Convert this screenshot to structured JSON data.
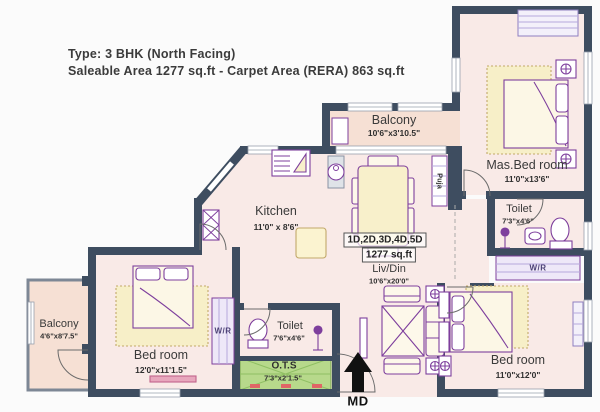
{
  "title": {
    "line1": "Type: 3 BHK (North Facing)",
    "line2": "Saleable Area 1277 sq.ft - Carpet Area (RERA) 863 sq.ft"
  },
  "unit": {
    "variants": "1D,2D,3D,4D,5D",
    "area": "1277 sq.ft"
  },
  "rooms": {
    "balcony_top": {
      "name": "Balcony",
      "dim": "10'6\"x3'10.5\""
    },
    "master_bedroom": {
      "name": "Mas.Bed room",
      "dim": "11'0\"x13'6\""
    },
    "master_toilet": {
      "name": "Toilet",
      "dim": "7'3\"x4'6\""
    },
    "kitchen": {
      "name": "Kitchen",
      "dim": "11'0\" x 8'6\""
    },
    "living_dining": {
      "name": "Liv/Din",
      "dim": "10'6\"x20'0\""
    },
    "left_balcony": {
      "name": "Balcony",
      "dim": "4'6\"x8'7.5\""
    },
    "left_bedroom": {
      "name": "Bed room",
      "dim": "12'0\"x11'1.5\""
    },
    "common_toilet": {
      "name": "Toilet",
      "dim": "7'6\"x4'6\""
    },
    "ots": {
      "name": "O.T.S",
      "dim": "7'3\"x2'1.5\""
    },
    "right_bedroom": {
      "name": "Bed room",
      "dim": "11'0\"x12'0\""
    }
  },
  "labels": {
    "wardrobe": "W/R",
    "puja": "Puja",
    "main_door": "MD"
  },
  "colors": {
    "wall": "#3e4d60",
    "room_fill": "#f9eae7",
    "balcony_fill": "#f6e0d4",
    "furniture_outline": "#7e3f9d",
    "furniture_fill": "#f8f0cb",
    "ots_green": "#b7d98b",
    "text": "#2f2f2f"
  }
}
